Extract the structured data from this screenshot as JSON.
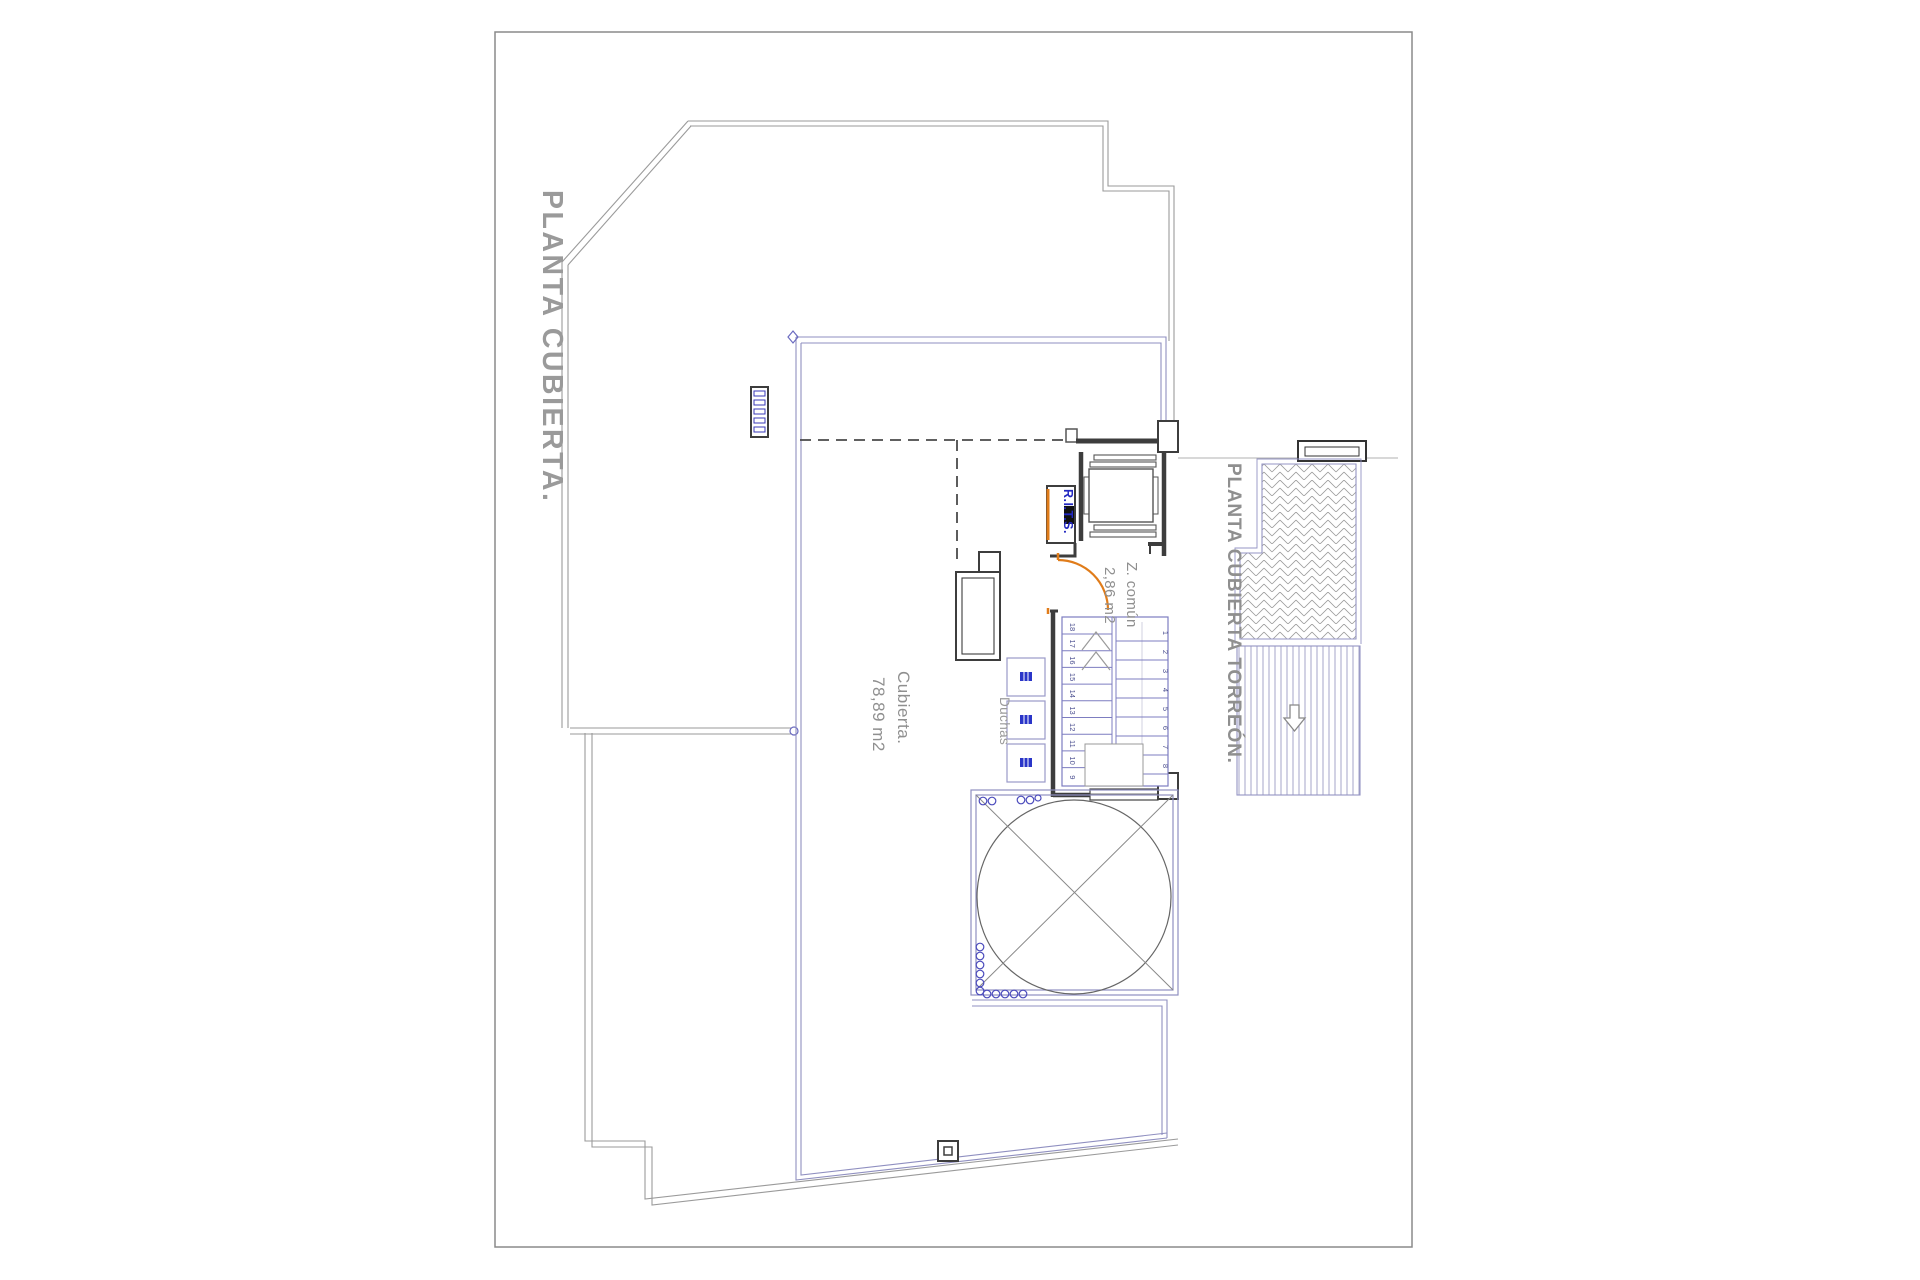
{
  "drawing": {
    "main_title": "PLANTA CUBIERTA.",
    "torreon_title": "PLANTA CUBIERTA TORREÓN.",
    "rooms": {
      "cubierta": {
        "label": "Cubierta.",
        "area": "78,89 m2"
      },
      "z_comun": {
        "label": "Z. común",
        "area": "2,86 m2"
      },
      "duchas_label": "Duchas",
      "rits_label": "R.I.T.S."
    },
    "stairs": {
      "left_numbers": [
        "18",
        "17",
        "16",
        "15",
        "14",
        "13",
        "12",
        "11",
        "10",
        "9"
      ],
      "right_numbers": [
        "1",
        "2",
        "3",
        "4",
        "5",
        "6",
        "7",
        "8"
      ]
    },
    "icons": {
      "stair_direction_arrow": "up-chevrons-icon",
      "torreon_slope_arrow": "down-arrow-icon"
    },
    "colors": {
      "outline_gray": "#9a9a9a",
      "wall_dark": "#3d3d3d",
      "boundary_blue": "#8f8fc0",
      "stair_blue": "#7d7dc0",
      "number_blue": "#4c5090",
      "accent_orange": "#e07c1a",
      "rits_blue": "#2228c0",
      "label_gray": "#8f8f8f",
      "shower_blue": "#2a35c8"
    }
  }
}
